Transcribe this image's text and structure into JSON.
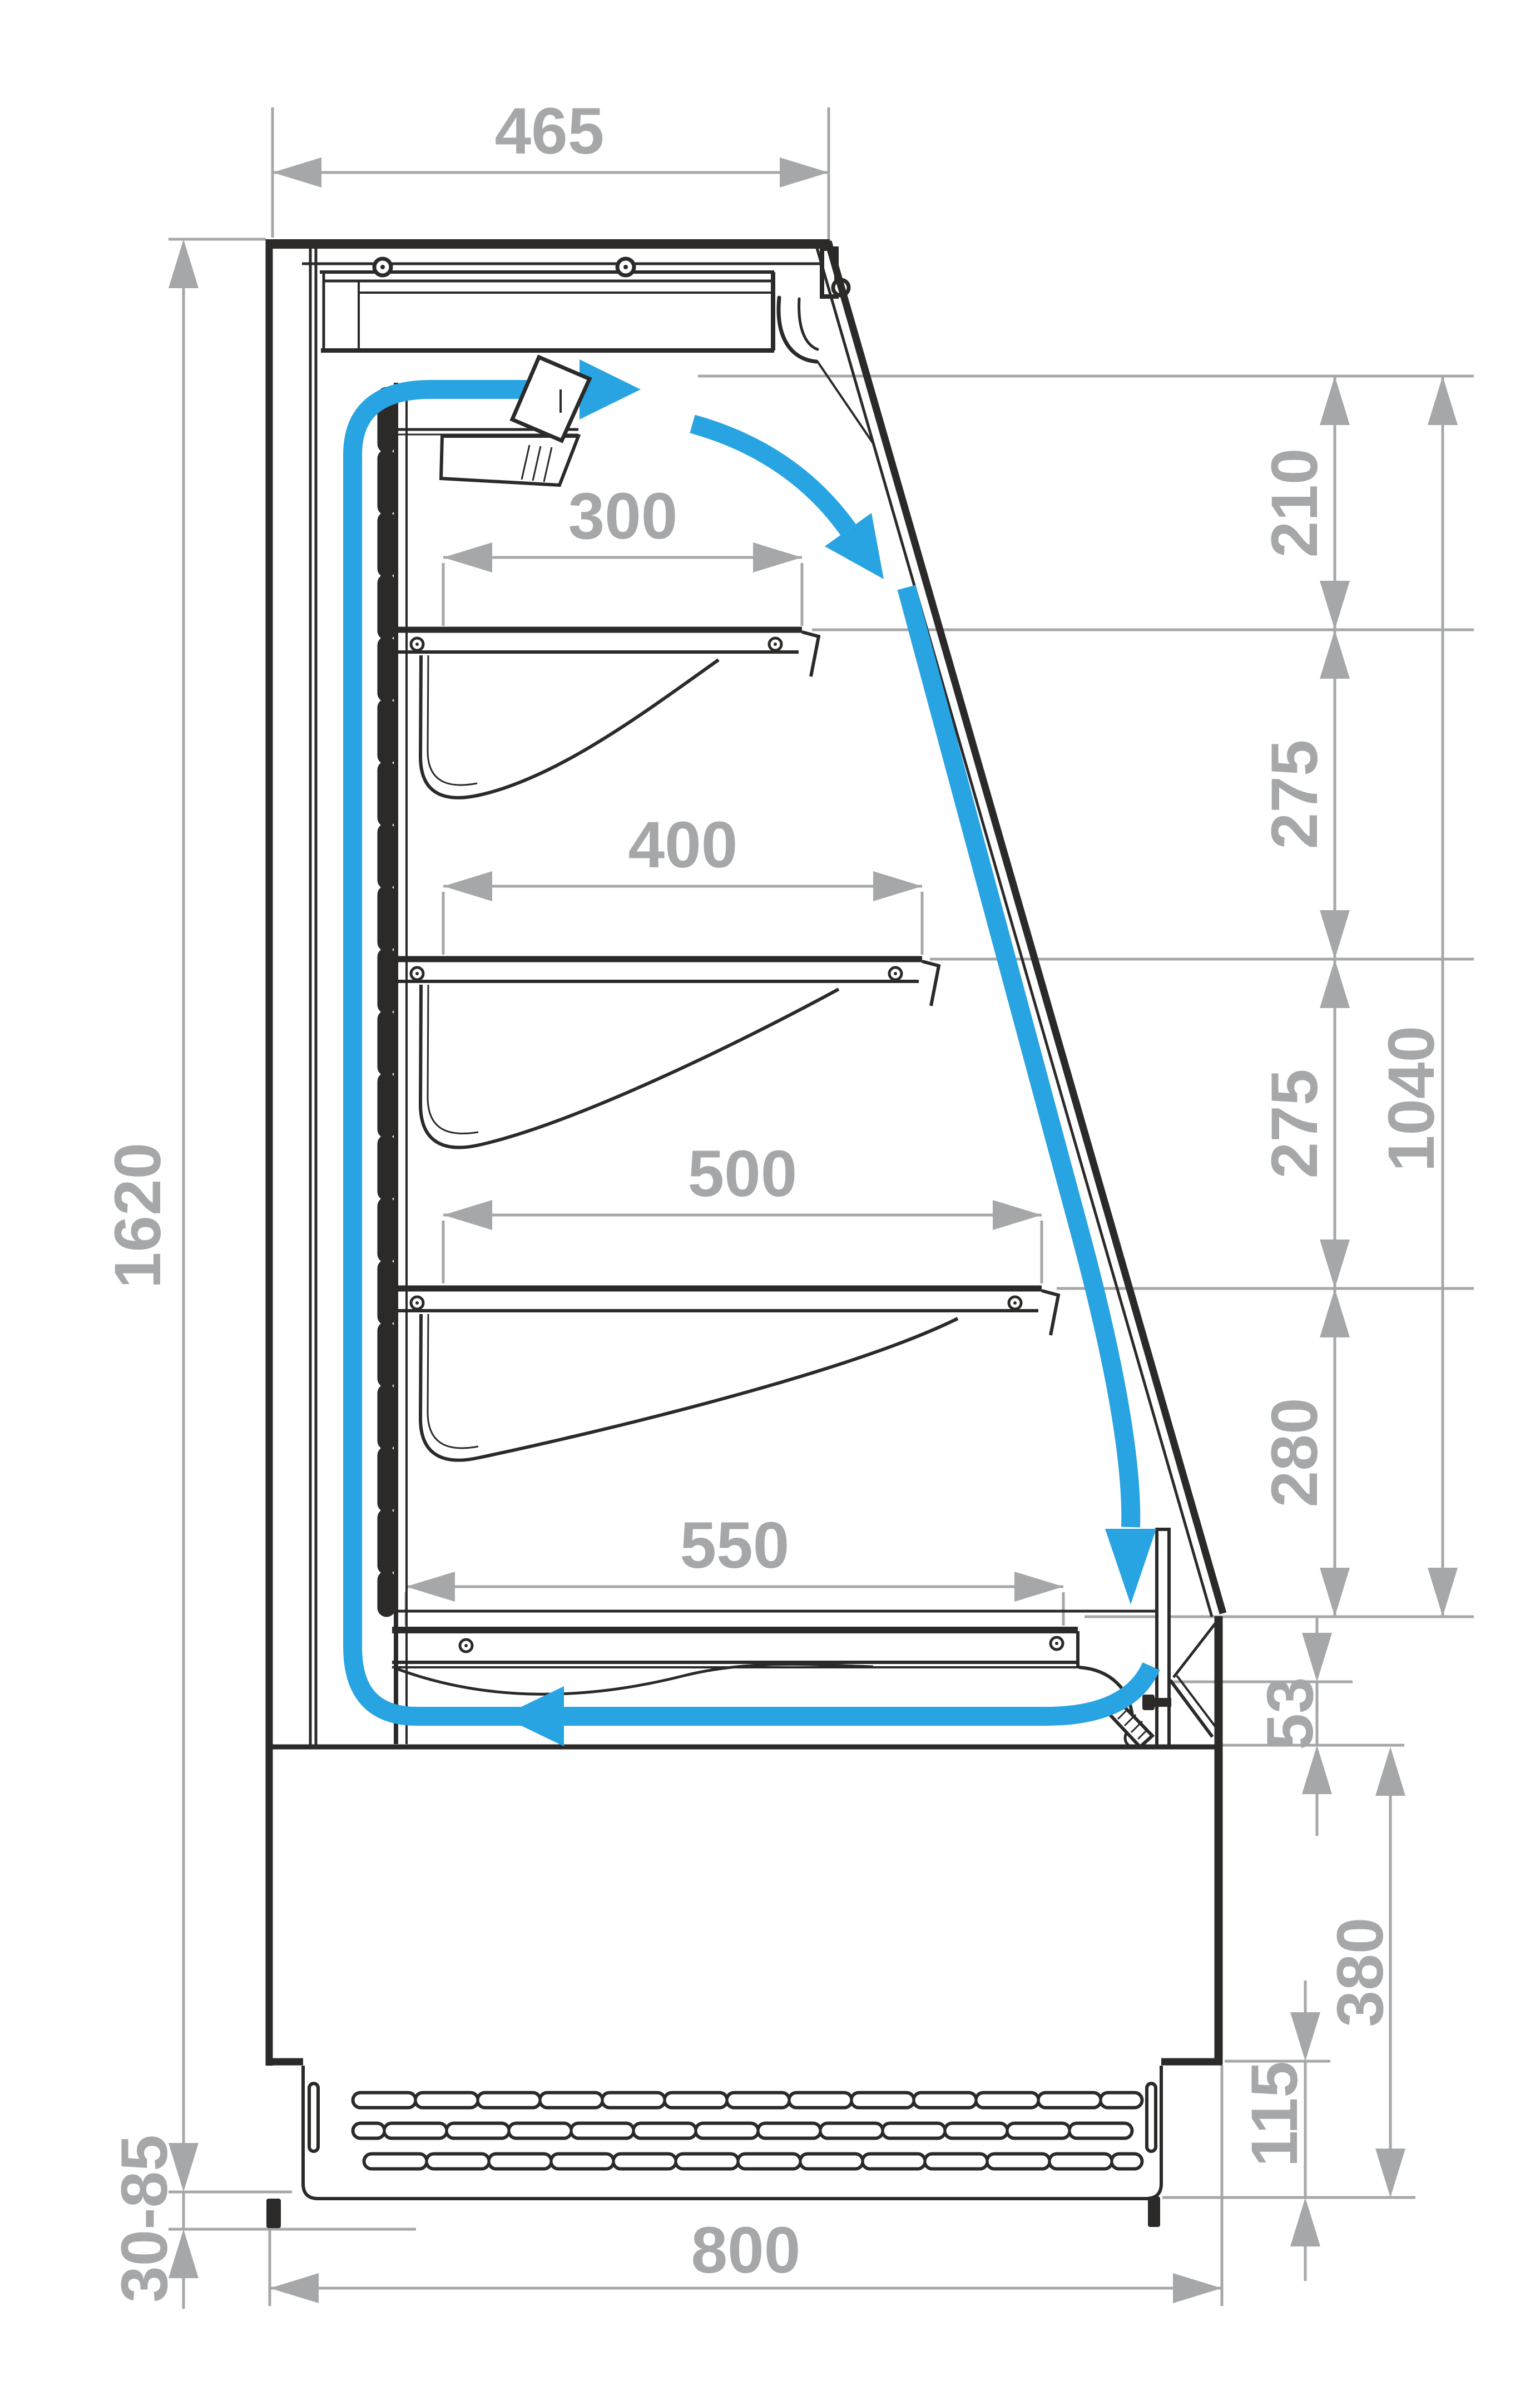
{
  "drawing": {
    "type": "technical-cross-section",
    "subject": "refrigerated open display case side section with airflow circulation",
    "units": "mm",
    "colors": {
      "line": "#2b2a29",
      "dimension": "#a5a7a9",
      "airflow": "#29a4e2"
    }
  },
  "dims": {
    "canopy_depth": "465",
    "total_height": "1620",
    "adjustable_feet": "30-85",
    "base_depth": "800",
    "shelves": [
      "300",
      "400",
      "500",
      "550"
    ],
    "right_spacings": [
      "210",
      "275",
      "275",
      "280"
    ],
    "opening_height": "1040",
    "front_gap": "53",
    "base_front_height": "380",
    "vent_panel_height": "115"
  }
}
